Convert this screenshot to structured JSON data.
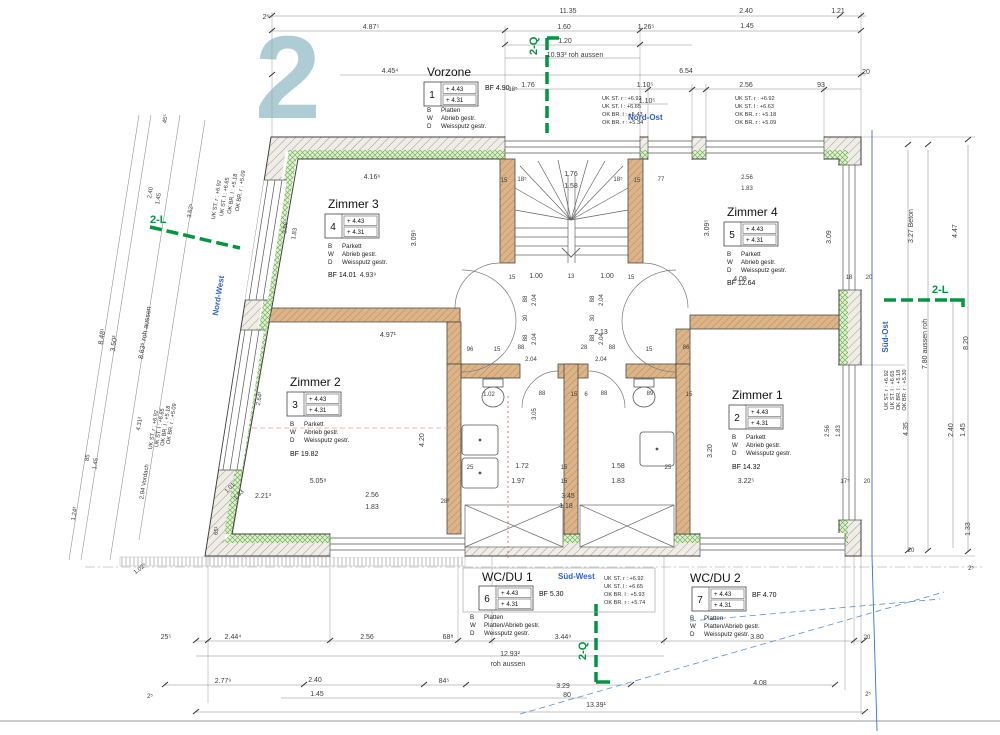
{
  "sheet": {
    "watermark": "2"
  },
  "compass": {
    "nordost": "Nord-Ost",
    "nordwest": "Nord-West",
    "suedost": "Süd-Ost",
    "suedwest": "Süd-West"
  },
  "markers": {
    "q": "2-Q",
    "l": "2-L"
  },
  "rooms": {
    "vorzone": {
      "title": "Vorzone",
      "num": "1",
      "e1": "+ 4.43",
      "e2": "+ 4.31",
      "bf": "BF  4.90",
      "m": [
        [
          "B",
          "Platten"
        ],
        [
          "W",
          "Abrieb gestr."
        ],
        [
          "D",
          "Weissputz gestr."
        ]
      ]
    },
    "z3": {
      "title": "Zimmer 3",
      "num": "4",
      "e1": "+ 4.43",
      "e2": "+ 4.31",
      "bf": "BF  14.01",
      "m": [
        [
          "B",
          "Parkett"
        ],
        [
          "W",
          "Abrieb gestr."
        ],
        [
          "D",
          "Weissputz gestr."
        ]
      ]
    },
    "z4": {
      "title": "Zimmer 4",
      "num": "5",
      "e1": "+ 4.43",
      "e2": "+ 4.31",
      "bf": "BF  12.64",
      "m": [
        [
          "B",
          "Parkett"
        ],
        [
          "W",
          "Abrieb gestr."
        ],
        [
          "D",
          "Weissputz gestr."
        ]
      ]
    },
    "z2": {
      "title": "Zimmer 2",
      "num": "3",
      "e1": "+ 4.43",
      "e2": "+ 4.31",
      "bf": "BF  19.82",
      "m": [
        [
          "B",
          "Parkett"
        ],
        [
          "W",
          "Abrieb gestr."
        ],
        [
          "D",
          "Weissputz gestr."
        ]
      ]
    },
    "z1": {
      "title": "Zimmer 1",
      "num": "2",
      "e1": "+ 4.43",
      "e2": "+ 4.31",
      "bf": "BF  14.32",
      "m": [
        [
          "B",
          "Parkett"
        ],
        [
          "W",
          "Abrieb gestr."
        ],
        [
          "D",
          "Weissputz gestr."
        ]
      ]
    },
    "wc1": {
      "title": "WC/DU 1",
      "num": "6",
      "e1": "+ 4.43",
      "e2": "+ 4.31",
      "bf": "BF  5.30",
      "m": [
        [
          "B",
          "Platten"
        ],
        [
          "W",
          "Platten/Abrieb gestr."
        ],
        [
          "D",
          "Weissputz gestr."
        ]
      ]
    },
    "wc2": {
      "title": "WC/DU 2",
      "num": "7",
      "e1": "+ 4.43",
      "e2": "+ 4.31",
      "bf": "BF  4.70",
      "m": [
        [
          "B",
          "Platten"
        ],
        [
          "W",
          "Platten/Abrieb gestr."
        ],
        [
          "D",
          "Weissputz gestr."
        ]
      ]
    }
  },
  "specs": {
    "a": [
      "UK ST. r : +6.92",
      "UK ST. l : +6.65",
      "OK BR. l : +5.43",
      "OK BR. r : +5.34"
    ],
    "b": [
      "UK ST. r : +6.92",
      "UK ST. l : +6.63",
      "OK BR. r : +5.18",
      "OK BR. r : +5.09"
    ],
    "c": [
      "UK ST. r : +6.92",
      "UK ST. l : +6.65",
      "OK BR. l : +5.93",
      "OK BR. r : +5.74"
    ],
    "d": [
      "UK ST. r : +6.92",
      "UK ST. l : +6.65",
      "OK BR. l : +5.18",
      "OK BR. r : +5.09"
    ],
    "e": [
      "UK ST. r : +6.92",
      "UK ST. l : +6.65",
      "OK BR. l : +5.18",
      "OK BR. r : +5.09"
    ],
    "f": [
      "UK ST. r : +6.92",
      "UK ST. l : +6.65",
      "OK BR. l : +5.18",
      "OK BR. r : +5.30"
    ]
  },
  "dims": {
    "top": [
      "2⁵",
      "11.35",
      "2.40",
      "1.21",
      "4.87⁵",
      "1.60",
      "1.26⁵",
      "1.45",
      "1.20",
      "10.93³  roh aussen",
      "4.45⁴",
      "6.54",
      "20",
      "18⁵",
      "1.76",
      "1.10⁵",
      "1.10⁵",
      "2.56",
      "93"
    ],
    "stair": [
      "15",
      "18⁵",
      "1.76",
      "1.58",
      "18⁵",
      "15",
      "77",
      "15",
      "1.00",
      "13",
      "1.00",
      "15"
    ],
    "hall": [
      "88",
      "2.04",
      "30",
      "88",
      "2.04",
      "88",
      "2.04",
      "30",
      "88",
      "2.04",
      "2.13",
      "96",
      "15",
      "88",
      "28",
      "88",
      "15",
      "86",
      "2.04",
      "2.04"
    ],
    "bath": [
      "1.02",
      "88",
      "15",
      "6",
      "88",
      "89",
      "15",
      "3.05",
      "25",
      "1.72",
      "15",
      "1.58",
      "25",
      "1.97",
      "15",
      "1.83",
      "3.45",
      "1.18",
      "2.56",
      "1.83",
      "28²",
      "5.05⁸",
      "2.21³",
      "3.22⁵",
      "17⁵",
      "20"
    ],
    "rooms": [
      "4.16⁶",
      "3.09⁵",
      "2.56",
      "1.83",
      "4.93⁹",
      "4.97¹",
      "2.64³",
      "4.20",
      "3.09⁵",
      "3.09",
      "2.56",
      "1.83",
      "4.08",
      "18",
      "20",
      "2.56",
      "1.83",
      "3.20"
    ],
    "right": [
      "3.27  Beton",
      "4.47",
      "7.80  aussen roh",
      "8.20",
      "4.35",
      "2.40",
      "1.45",
      "1.33",
      "2⁵",
      "20"
    ],
    "left": [
      "45⁵",
      "2.40",
      "1.45",
      "3.52⁵",
      "8.48¹",
      "3.50³",
      "8.63⁹  roh aussen",
      "4.31²",
      "85",
      "1.45",
      "2.94  Vordach",
      "1.24³",
      "65¹",
      "1.01",
      "1.63",
      "1.02⁵",
      "2⁵"
    ],
    "bottom": [
      "25⁵",
      "2.44⁴",
      "2.56",
      "68⁸",
      "3.44⁹",
      "3.80",
      "20",
      "12.93²",
      "roh aussen",
      "2.77⁹",
      "2.40",
      "84⁵",
      "3.29",
      "4.08",
      "1.45",
      "80",
      "13.39¹",
      "2⁵"
    ]
  }
}
